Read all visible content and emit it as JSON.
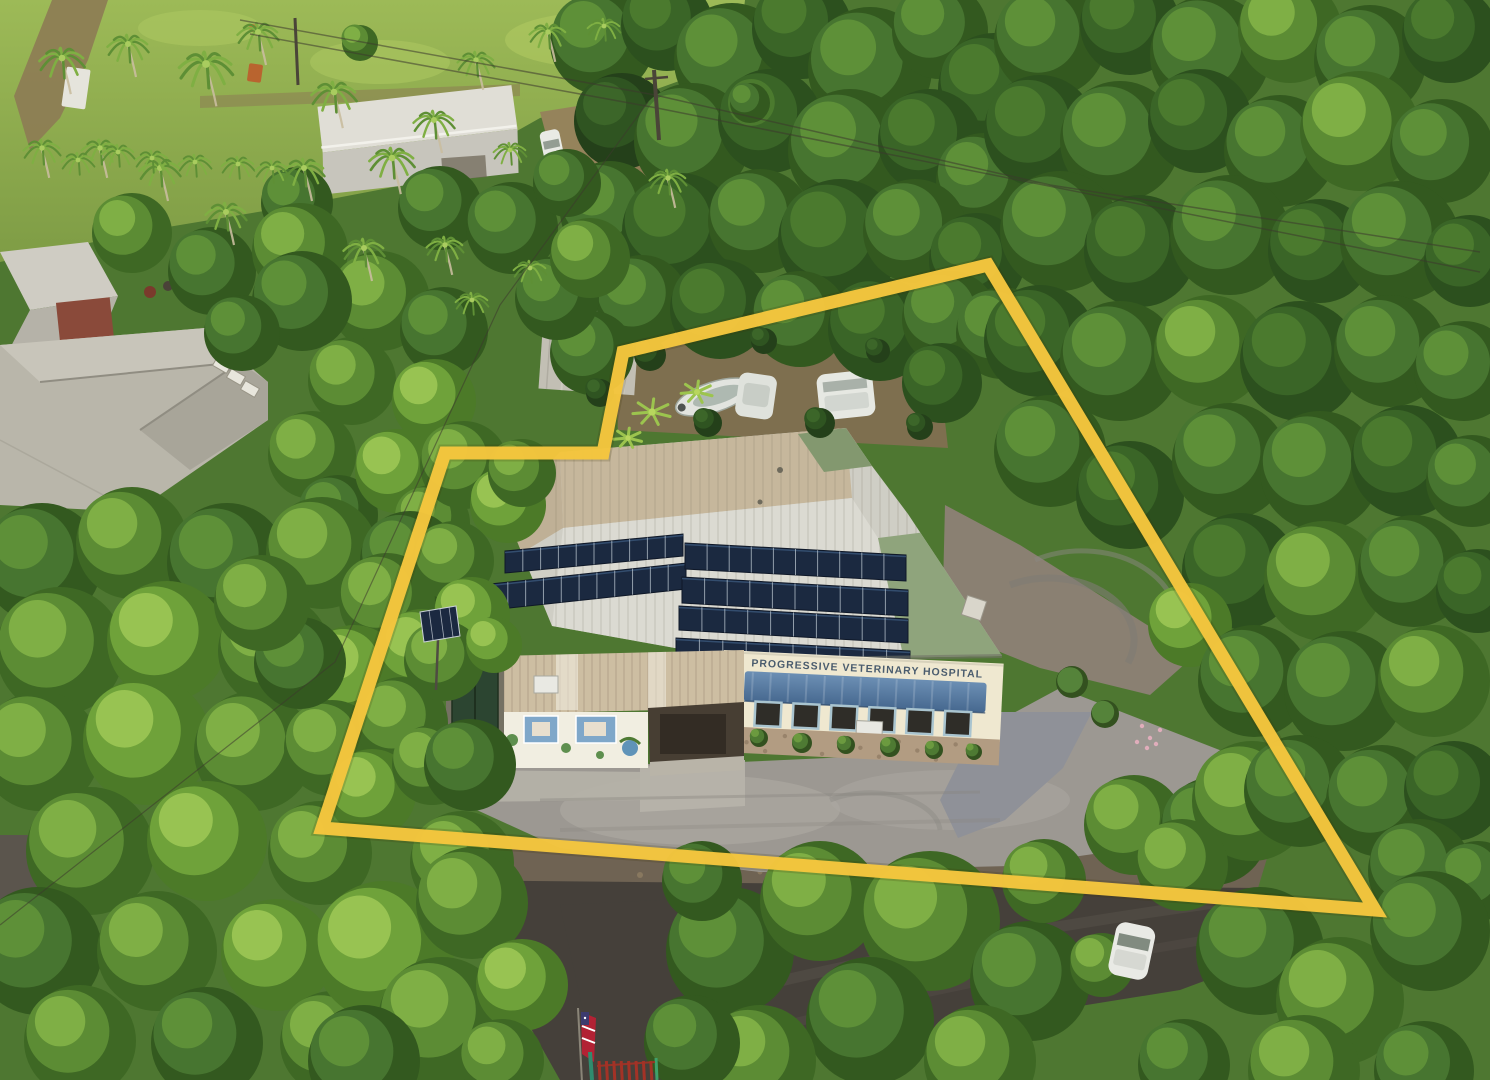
{
  "meta": {
    "description": "Aerial drone photograph of a tropical property outlined with a yellow boundary line; metal-roofed veterinary hospital with rooftop solar panels, gravel parking, surrounding dense tree canopy, palm trees, lawns, neighboring roofs, a street with a white car, an American flag and red gate at the entrance.",
    "width": 1490,
    "height": 1080
  },
  "sign": {
    "text": "PROGRESSIVE VETERINARY HOSPITAL"
  },
  "boundary": {
    "points": "988,265 623,352 603,453 445,453 322,828 1375,910",
    "stroke_width": 13
  },
  "colors": {
    "base": "#4E7731",
    "lawn_top": "#9DBA57",
    "lawn_bottom": "#7E9C45",
    "lawn_light": "#ACC660",
    "dirt": "#8D7B54",
    "backyard": "#7E6F4F",
    "dirt_yard": "#8A8072",
    "road": "#45403A",
    "road_light": "#5B554D",
    "shoulder": "#6F6353",
    "gravel": "#9C9892",
    "gravel_light": "#ACA8A1",
    "drive_gravel": "#8F9198",
    "concrete": "#B6B2A9",
    "roof_base": "#CFCEC5",
    "roof_tan": "#C6B79C",
    "roof_tan2": "#BFB096",
    "roof_silver": "#DBDAD2",
    "roof_green": "#8FA47C",
    "roof_green2": "#83986F",
    "annex_roof": "#CDBEA2",
    "facade": "#EFE8D0",
    "sign_text": "#3D5166",
    "awning_top": "#6C8FB4",
    "awning_bottom": "#46688F",
    "solar": "#1B2940",
    "solar_line": "#B9C4CE",
    "stone": "#B29C82",
    "stone_wall": "#C9BFAC",
    "mural_wall": "#F1EEE1",
    "mural_blue": "#7FA7C9",
    "mural_green": "#5E8F4E",
    "porch": "#473E33",
    "porch_dark": "#332C24",
    "porch_floor": "#B9B4A8",
    "green_doors": "#2C4531",
    "warehouse": "#B9B6AA",
    "warehouse_light": "#C8C5BA",
    "house_roof": "#E0DED6",
    "house_roof2": "#C7C5BC",
    "shed_roof": "#C2BFB4",
    "container": "#8A4A30",
    "vehicle": "#E9EAE5",
    "boat": "#E2E4DF",
    "flag_red": "#B22234",
    "flag_blue": "#3C3B6E",
    "gate": "#A33226",
    "wire": "#3C382D",
    "trunk": "#C9BD9E",
    "pole": "#4A4438",
    "window_frame": "#A9C4CF",
    "window_glass": "#2F2D28",
    "boundary": "#F5C63E"
  },
  "scene": {
    "tones": [
      [
        "#2C501E",
        "#3A6527",
        "#4B7A2E"
      ],
      [
        "#33591F",
        "#477530",
        "#5E9038"
      ],
      [
        "#3E6824",
        "#5C8C34",
        "#7FAF45"
      ],
      [
        "#4C7A28",
        "#6FA23A",
        "#98C352"
      ],
      [
        "#24401A",
        "#2F5421",
        "#3C6629"
      ]
    ],
    "trees": [
      [
        600,
        40,
        52,
        1
      ],
      [
        665,
        22,
        46,
        0
      ],
      [
        730,
        58,
        58,
        1
      ],
      [
        800,
        26,
        50,
        0
      ],
      [
        868,
        66,
        62,
        1
      ],
      [
        938,
        28,
        48,
        1
      ],
      [
        992,
        86,
        56,
        0
      ],
      [
        620,
        118,
        48,
        4
      ],
      [
        690,
        138,
        58,
        1
      ],
      [
        768,
        118,
        52,
        0
      ],
      [
        848,
        148,
        62,
        1
      ],
      [
        928,
        138,
        52,
        0
      ],
      [
        982,
        178,
        48,
        1
      ],
      [
        608,
        208,
        50,
        1
      ],
      [
        678,
        228,
        58,
        0
      ],
      [
        758,
        218,
        52,
        1
      ],
      [
        838,
        238,
        62,
        0
      ],
      [
        913,
        228,
        52,
        1
      ],
      [
        975,
        258,
        48,
        0
      ],
      [
        640,
        298,
        46,
        1
      ],
      [
        718,
        306,
        50,
        0
      ],
      [
        798,
        316,
        48,
        1
      ],
      [
        878,
        326,
        52,
        0
      ],
      [
        948,
        316,
        48,
        1
      ],
      [
        590,
        350,
        42,
        1
      ],
      [
        1000,
        330,
        46,
        1
      ],
      [
        940,
        380,
        40,
        0
      ],
      [
        1048,
        38,
        56,
        1
      ],
      [
        1128,
        22,
        50,
        0
      ],
      [
        1208,
        52,
        60,
        1
      ],
      [
        1288,
        28,
        52,
        2
      ],
      [
        1368,
        58,
        56,
        1
      ],
      [
        1448,
        32,
        48,
        0
      ],
      [
        1038,
        128,
        56,
        0
      ],
      [
        1118,
        138,
        60,
        1
      ],
      [
        1198,
        118,
        52,
        0
      ],
      [
        1278,
        148,
        56,
        1
      ],
      [
        1358,
        128,
        60,
        2
      ],
      [
        1440,
        148,
        52,
        1
      ],
      [
        1058,
        228,
        60,
        1
      ],
      [
        1138,
        248,
        56,
        0
      ],
      [
        1228,
        232,
        60,
        1
      ],
      [
        1318,
        248,
        52,
        0
      ],
      [
        1398,
        238,
        60,
        1
      ],
      [
        1468,
        258,
        46,
        0
      ],
      [
        1038,
        338,
        56,
        0
      ],
      [
        1118,
        358,
        60,
        1
      ],
      [
        1208,
        348,
        56,
        2
      ],
      [
        1298,
        358,
        60,
        0
      ],
      [
        1388,
        348,
        56,
        1
      ],
      [
        1462,
        368,
        50,
        1
      ],
      [
        1048,
        448,
        56,
        1
      ],
      [
        1128,
        492,
        54,
        0
      ],
      [
        1228,
        458,
        58,
        1
      ],
      [
        1318,
        468,
        60,
        1
      ],
      [
        1405,
        458,
        56,
        0
      ],
      [
        1470,
        478,
        46,
        1
      ],
      [
        1238,
        568,
        58,
        0
      ],
      [
        1322,
        578,
        60,
        2
      ],
      [
        1412,
        568,
        56,
        1
      ],
      [
        1476,
        588,
        42,
        0
      ],
      [
        1188,
        622,
        42,
        3
      ],
      [
        1252,
        678,
        56,
        1
      ],
      [
        1342,
        688,
        60,
        1
      ],
      [
        1432,
        678,
        56,
        2
      ],
      [
        1132,
        822,
        50,
        2
      ],
      [
        1212,
        828,
        54,
        1
      ],
      [
        1250,
        798,
        60,
        2
      ],
      [
        1180,
        862,
        46,
        2
      ],
      [
        1298,
        788,
        56,
        1
      ],
      [
        1380,
        798,
        56,
        1
      ],
      [
        1452,
        788,
        50,
        0
      ],
      [
        1418,
        868,
        52,
        1
      ],
      [
        1476,
        878,
        40,
        1
      ],
      [
        438,
        205,
        42,
        1
      ],
      [
        510,
        225,
        46,
        1
      ],
      [
        555,
        295,
        42,
        1
      ],
      [
        588,
        255,
        40,
        2
      ],
      [
        565,
        180,
        34,
        1
      ],
      [
        295,
        200,
        36,
        1
      ],
      [
        358,
        40,
        18,
        2
      ],
      [
        748,
        100,
        20,
        1
      ],
      [
        130,
        230,
        40,
        2
      ],
      [
        210,
        268,
        44,
        1
      ],
      [
        298,
        248,
        48,
        2
      ],
      [
        378,
        298,
        50,
        2
      ],
      [
        442,
        328,
        44,
        1
      ],
      [
        350,
        378,
        44,
        2
      ],
      [
        432,
        398,
        42,
        3
      ],
      [
        300,
        298,
        50,
        1
      ],
      [
        240,
        330,
        38,
        1
      ],
      [
        310,
        452,
        44,
        2
      ],
      [
        336,
        512,
        40,
        1
      ],
      [
        395,
        468,
        42,
        3
      ],
      [
        430,
        520,
        38,
        2
      ],
      [
        302,
        545,
        38,
        1
      ],
      [
        40,
        560,
        60,
        1
      ],
      [
        130,
        540,
        56,
        2
      ],
      [
        225,
        560,
        60,
        1
      ],
      [
        320,
        550,
        56,
        2
      ],
      [
        408,
        558,
        50,
        1
      ],
      [
        58,
        648,
        64,
        2
      ],
      [
        165,
        638,
        60,
        3
      ],
      [
        272,
        648,
        56,
        2
      ],
      [
        385,
        598,
        48,
        2
      ],
      [
        352,
        672,
        50,
        3
      ],
      [
        38,
        748,
        60,
        2
      ],
      [
        145,
        738,
        64,
        3
      ],
      [
        252,
        748,
        60,
        2
      ],
      [
        330,
        745,
        48,
        2
      ],
      [
        420,
        650,
        44,
        3
      ],
      [
        88,
        848,
        64,
        2
      ],
      [
        205,
        838,
        60,
        3
      ],
      [
        318,
        850,
        52,
        2
      ],
      [
        400,
        720,
        46,
        2
      ],
      [
        370,
        790,
        44,
        3
      ],
      [
        36,
        948,
        64,
        1
      ],
      [
        155,
        948,
        60,
        2
      ],
      [
        275,
        952,
        56,
        3
      ],
      [
        430,
        762,
        40,
        2
      ],
      [
        78,
        1038,
        56,
        2
      ],
      [
        205,
        1040,
        56,
        1
      ],
      [
        330,
        1040,
        52,
        2
      ],
      [
        460,
        860,
        52,
        2
      ],
      [
        468,
        762,
        46,
        1
      ],
      [
        298,
        660,
        46,
        1
      ],
      [
        260,
        600,
        48,
        2
      ],
      [
        462,
        462,
        44,
        2
      ],
      [
        506,
        502,
        38,
        3
      ],
      [
        452,
        558,
        40,
        2
      ],
      [
        470,
        612,
        38,
        3
      ],
      [
        442,
        658,
        40,
        2
      ],
      [
        492,
        642,
        28,
        3
      ],
      [
        520,
        470,
        34,
        2
      ],
      [
        648,
        352,
        16,
        4
      ],
      [
        706,
        420,
        14,
        4
      ],
      [
        762,
        338,
        13,
        4
      ],
      [
        818,
        420,
        15,
        4
      ],
      [
        876,
        348,
        12,
        4
      ],
      [
        918,
        424,
        13,
        4
      ],
      [
        598,
        390,
        14,
        4
      ],
      [
        382,
        948,
        70,
        3
      ],
      [
        470,
        900,
        56,
        2
      ],
      [
        440,
        1018,
        64,
        2
      ],
      [
        362,
        1058,
        56,
        1
      ],
      [
        520,
        982,
        46,
        3
      ],
      [
        500,
        1058,
        42,
        2
      ],
      [
        728,
        948,
        64,
        1
      ],
      [
        818,
        898,
        60,
        2
      ],
      [
        928,
        918,
        70,
        2
      ],
      [
        1028,
        978,
        60,
        1
      ],
      [
        868,
        1018,
        64,
        1
      ],
      [
        978,
        1058,
        56,
        2
      ],
      [
        758,
        1058,
        56,
        2
      ],
      [
        700,
        878,
        40,
        1
      ],
      [
        1042,
        878,
        42,
        2
      ],
      [
        690,
        1040,
        48,
        1
      ],
      [
        1100,
        962,
        32,
        2
      ],
      [
        1258,
        948,
        64,
        1
      ],
      [
        1338,
        998,
        64,
        2
      ],
      [
        1428,
        928,
        60,
        1
      ],
      [
        1302,
        1068,
        56,
        2
      ],
      [
        1422,
        1068,
        50,
        1
      ],
      [
        1182,
        1062,
        46,
        1
      ]
    ],
    "palms": [
      [
        62,
        58,
        11
      ],
      [
        128,
        44,
        10
      ],
      [
        206,
        64,
        13
      ],
      [
        258,
        32,
        10
      ],
      [
        334,
        92,
        11
      ],
      [
        392,
        158,
        11
      ],
      [
        304,
        168,
        10
      ],
      [
        160,
        168,
        10
      ],
      [
        100,
        148,
        9
      ],
      [
        226,
        212,
        10
      ],
      [
        364,
        248,
        10
      ],
      [
        434,
        120,
        10
      ],
      [
        476,
        60,
        9
      ],
      [
        548,
        32,
        9
      ],
      [
        604,
        26,
        8
      ],
      [
        668,
        178,
        9
      ],
      [
        445,
        245,
        9
      ],
      [
        472,
        300,
        8
      ],
      [
        42,
        148,
        9
      ],
      [
        118,
        152,
        8
      ],
      [
        152,
        158,
        8
      ],
      [
        195,
        162,
        8
      ],
      [
        238,
        164,
        8
      ],
      [
        272,
        168,
        8
      ],
      [
        530,
        268,
        8
      ],
      [
        510,
        150,
        8
      ],
      [
        78,
        160,
        8
      ]
    ],
    "bananas": [
      [
        652,
        412,
        12
      ],
      [
        697,
        392,
        10
      ],
      [
        628,
        438,
        9
      ]
    ],
    "wires": [
      "240,20 655,95 1050,185 1480,252",
      "250,34 657,108 1480,272",
      "648,102 500,305 335,662 0,925"
    ],
    "poles": [
      [
        654,
        70,
        659,
        140
      ],
      [
        295,
        18,
        298,
        85
      ]
    ],
    "solar_rows": [
      {
        "x1": 505,
        "y1": 551,
        "x2": 683,
        "y2": 534,
        "h": 22,
        "n": 10
      },
      {
        "x1": 490,
        "y1": 584,
        "x2": 686,
        "y2": 563,
        "h": 26,
        "n": 11
      },
      {
        "x1": 685,
        "y1": 543,
        "x2": 906,
        "y2": 555,
        "h": 26,
        "n": 10
      },
      {
        "x1": 682,
        "y1": 577,
        "x2": 908,
        "y2": 590,
        "h": 26,
        "n": 10
      },
      {
        "x1": 679,
        "y1": 606,
        "x2": 908,
        "y2": 619,
        "h": 24,
        "n": 10
      },
      {
        "x1": 676,
        "y1": 638,
        "x2": 910,
        "y2": 651,
        "h": 22,
        "n": 10
      }
    ],
    "windows_x": [
      758,
      796,
      834,
      872,
      910,
      948
    ],
    "bushes_front": [
      [
        757,
        736,
        9
      ],
      [
        800,
        741,
        10
      ],
      [
        844,
        743,
        9
      ],
      [
        888,
        745,
        10
      ],
      [
        932,
        748,
        9
      ],
      [
        972,
        750,
        8
      ]
    ],
    "bushes_drive": [
      [
        1070,
        680,
        16
      ],
      [
        1103,
        712,
        14
      ]
    ],
    "pink_flowers": [
      [
        1142,
        726
      ],
      [
        1150,
        738
      ],
      [
        1160,
        730
      ],
      [
        1147,
        748
      ],
      [
        1156,
        744
      ],
      [
        1137,
        742
      ]
    ]
  }
}
